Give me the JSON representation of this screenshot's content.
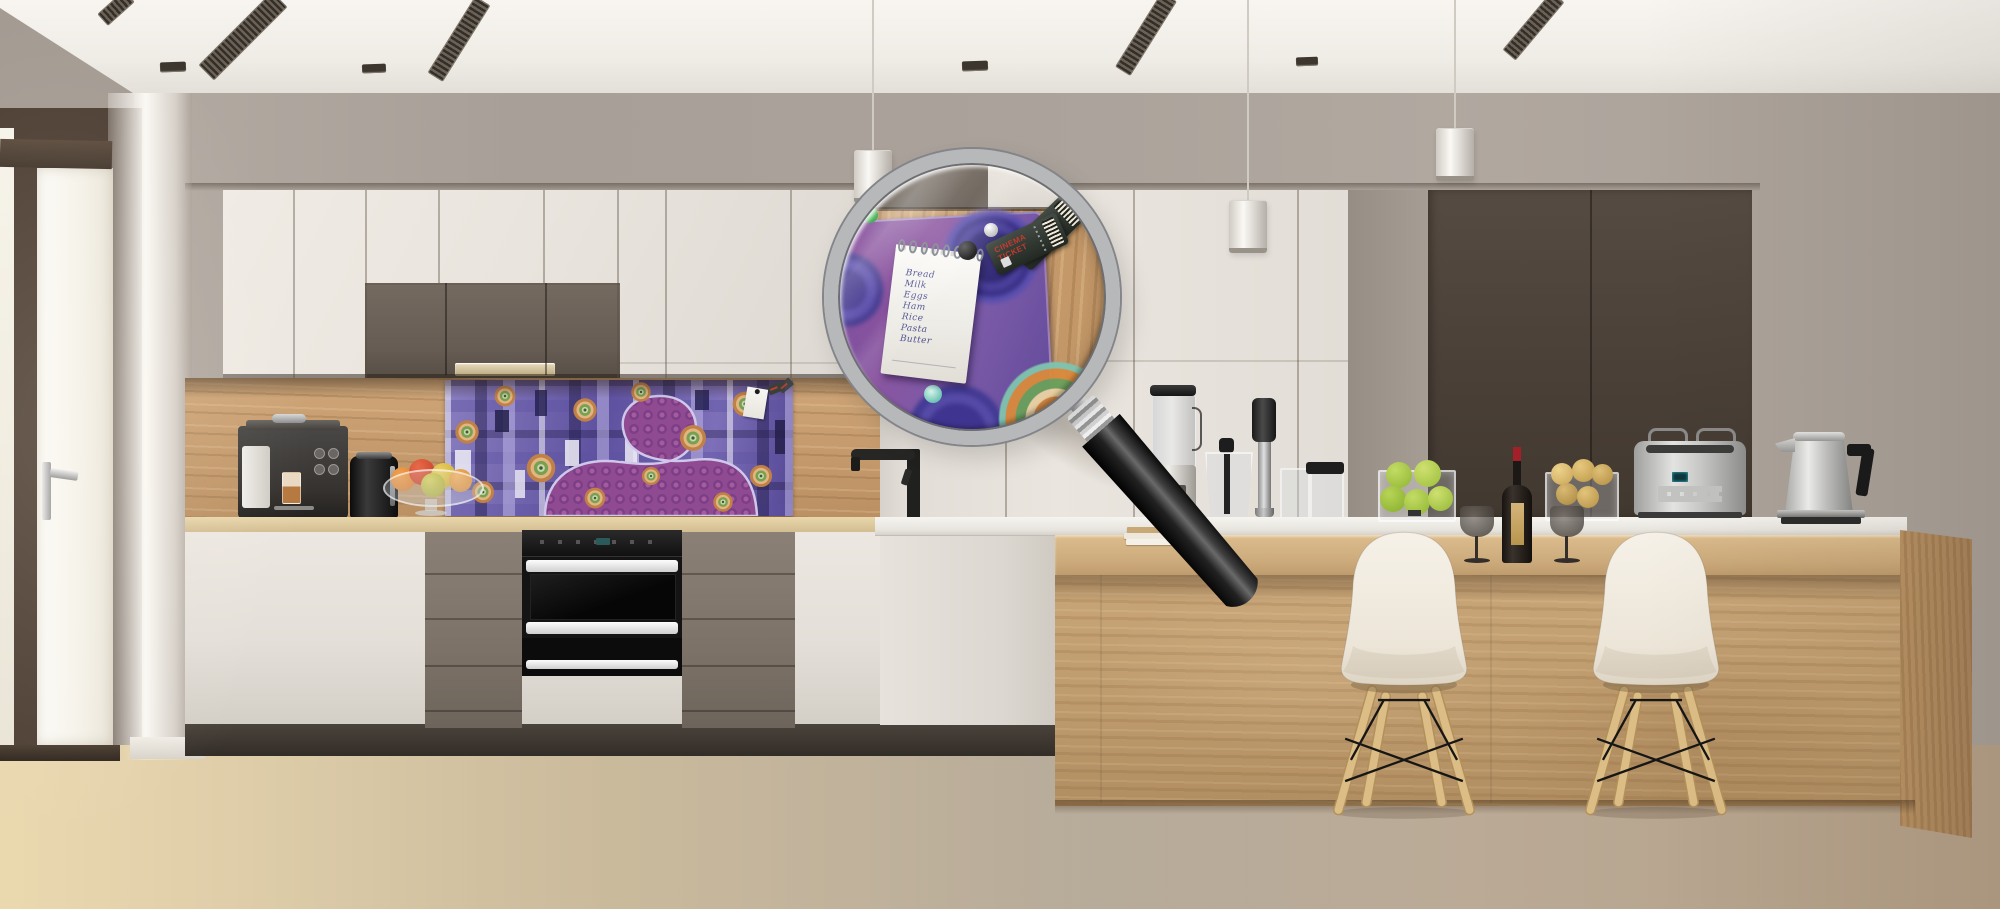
{
  "scene": {
    "kind": "kitchen-product-photo",
    "description": "Modern kitchen with purple abstract magnetic memo-board backsplash; a magnifying glass enlarges a pinned shopping-list notepad and cinema tickets"
  },
  "palette": {
    "wall": "#aaa29a",
    "ceiling": "#f6f3ee",
    "cabinet-white": "#eae5de",
    "cabinet-brown": "#6b6058",
    "cabinet-dark": "#4a4039",
    "wood-backsplash": "#c49a6c",
    "art-purple": "#7468b2",
    "counter-white": "#f2efe9",
    "island-wood": "#c8a578",
    "floor-wood": "#e3c795",
    "chair-cream": "#efe9dd",
    "ticket-red": "#c23a2e",
    "wine-cap-red": "#a42028",
    "apple-green": "#9ec43e"
  },
  "magnifier": {
    "note": {
      "items": [
        "Bread",
        "Milk",
        "Eggs",
        "Ham",
        "Rice",
        "Pasta",
        "Butter"
      ]
    },
    "tickets": {
      "label": "CINEMA TICKET"
    },
    "magnets": [
      "green",
      "black",
      "pearl",
      "teal"
    ]
  },
  "objects": {
    "left_counter": [
      "espresso-machine",
      "black-kettle",
      "fruit-bowl"
    ],
    "back_counter": [
      "stand-blender",
      "chopper-jug",
      "hand-blender",
      "food-processor-cups"
    ],
    "island": [
      "apple-vase",
      "wine-glass",
      "wine-bottle",
      "wine-glass",
      "lemon-vase",
      "toaster",
      "steel-kettle",
      "book-stack"
    ],
    "seating": [
      "bar-chair",
      "bar-chair"
    ],
    "ceiling": [
      "vent",
      "vent",
      "vent",
      "vent",
      "spotlight",
      "pendant-lamp",
      "pendant-lamp",
      "pendant-lamp"
    ]
  }
}
